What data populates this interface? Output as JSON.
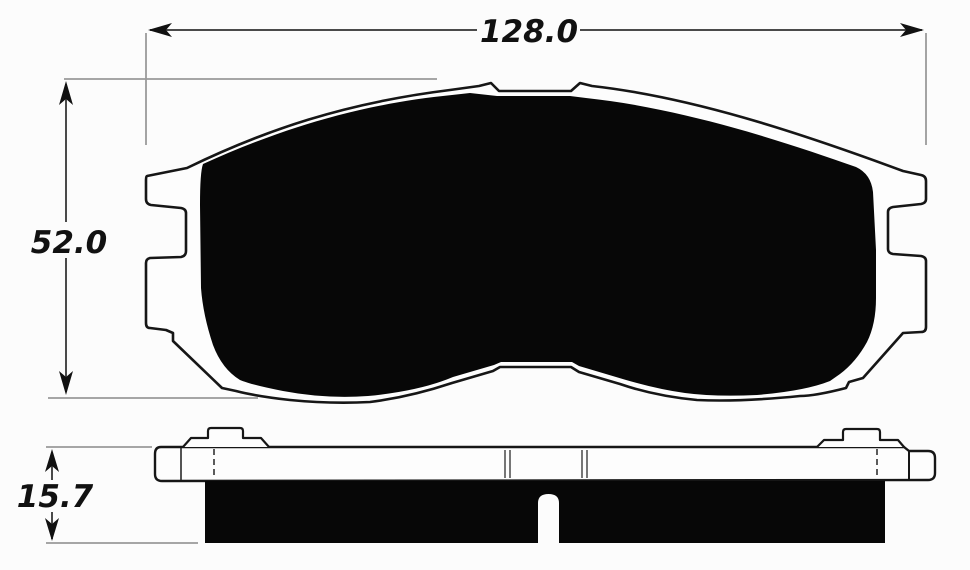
{
  "drawing": {
    "dimensions": {
      "width": "128.0",
      "height": "52.0",
      "thickness": "15.7"
    },
    "colors": {
      "background": "#fcfcfc",
      "outline": "#161616",
      "friction_fill": "#070707",
      "dimension_line": "#4a4a4a",
      "extension_line": "#9a9a9a",
      "label_text": "#111111"
    }
  }
}
